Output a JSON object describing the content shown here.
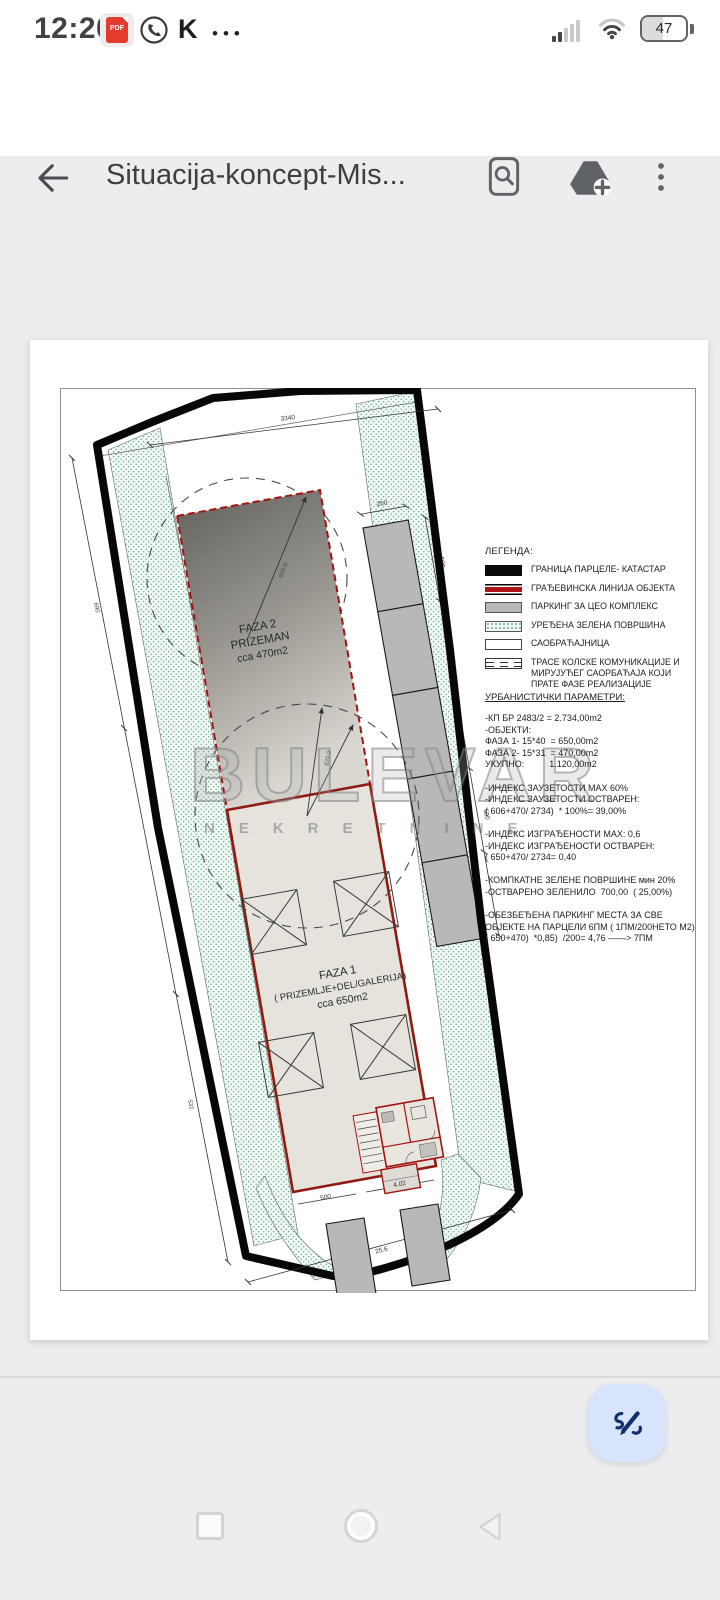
{
  "status_bar": {
    "time": "12:20",
    "pdf_badge": "PDF",
    "k_label": "K",
    "more_dots": "•••",
    "battery_percent": "47"
  },
  "app_bar": {
    "title": "Situacija-koncept-Mis..."
  },
  "drawing": {
    "faza2": {
      "l1": "FAZA 2",
      "l2": "PRIZEMAN",
      "l3": "cca 470m2"
    },
    "faza1": {
      "l1": "FAZA 1",
      "l2": "( PRIZEMLJE+DEL/GALERIJA)",
      "l3": "cca 650m2"
    },
    "dims": {
      "top": "3340",
      "radius_top": "820.0",
      "radius_mid": "820.0",
      "stall_depth": "250",
      "stall_len_a": "500",
      "stall_len_b": "500",
      "left_a": "690",
      "left_b": "532",
      "vestibule": "500",
      "entry": "4.02",
      "bottom_width": "25.6"
    }
  },
  "legend": {
    "title": "ЛЕГЕНДА:",
    "items": [
      {
        "type": "black",
        "label": "ГРАНИЦА ПАРЦЕЛЕ- КАТАСТАР"
      },
      {
        "type": "redline",
        "label": "ГРАЂЕВИНСКА ЛИНИЈА ОБЈЕКТА"
      },
      {
        "type": "gray",
        "label": "ПАРКИНГ ЗА ЦЕО КОМПЛЕКС"
      },
      {
        "type": "green",
        "label": "УРЕЂЕНА ЗЕЛЕНА ПОВРШИНА"
      },
      {
        "type": "white",
        "label": "САОБРАЋАЈНИЦА"
      },
      {
        "type": "dashes",
        "label": "ТРАСЕ КОЛСКЕ КОМУНИКАЦИЈЕ И МИРУЈУЋЕГ САОРБАЋАЈА КОЈИ ПРАТЕ ФАЗЕ РЕАЛИЗАЦИЈЕ"
      }
    ]
  },
  "params": {
    "heading": "УРБАНИСТИЧКИ ПАРАМЕТРИ:",
    "lines": [
      "-КП БР 2483/2 = 2.734,00m2",
      "-ОБЈЕКТИ:",
      "ФАЗА 1- 15*40  = 650,00m2",
      "ФАЗА 2- 15*31  = 470,00m2",
      "УКУПНО:          1.120,00m2",
      "",
      "-ИНДЕКС ЗАУЗЕТОСТИ МАХ 60%",
      "-ИНДЕКС ЗАУЗЕТОСТИ ОСТВАРЕН:",
      "( 606+470/ 2734)  * 100%= 39,00%",
      "",
      "-ИНДЕКС ИЗГРАЂЕНОСТИ МАХ: 0,6",
      "-ИНДЕКС ИЗГРАЂЕНОСТИ ОСТВАРЕН:",
      "( 650+470/ 2734= 0,40",
      "",
      "-КОМПКАТНЕ ЗЕЛЕНЕ ПОВРШИНЕ мин 20%",
      "-ОСТВАРЕНО ЗЕЛЕНИЛО  700,00  ( 25,00%)",
      "",
      "-ОБЕЗБЕЂЕНА ПАРКИНГ МЕСТА ЗА СВЕ",
      "ОБЈЕКТЕ НА ПАРЦЕЛИ 6ПМ ( 1ПМ/200НЕТО М2)",
      "( 650+470)  *0,85)  /200= 4,76 ——> 7ПМ"
    ]
  },
  "watermark": {
    "line1": "BULEVAR",
    "line2": "NEKRETNINE"
  },
  "colors": {
    "accent_red": "#8e1a10",
    "green_dot": "#68ab91",
    "parking_gray": "#b8b8b6",
    "fab_bg": "#d8e3fc",
    "fab_icon": "#12306b"
  }
}
